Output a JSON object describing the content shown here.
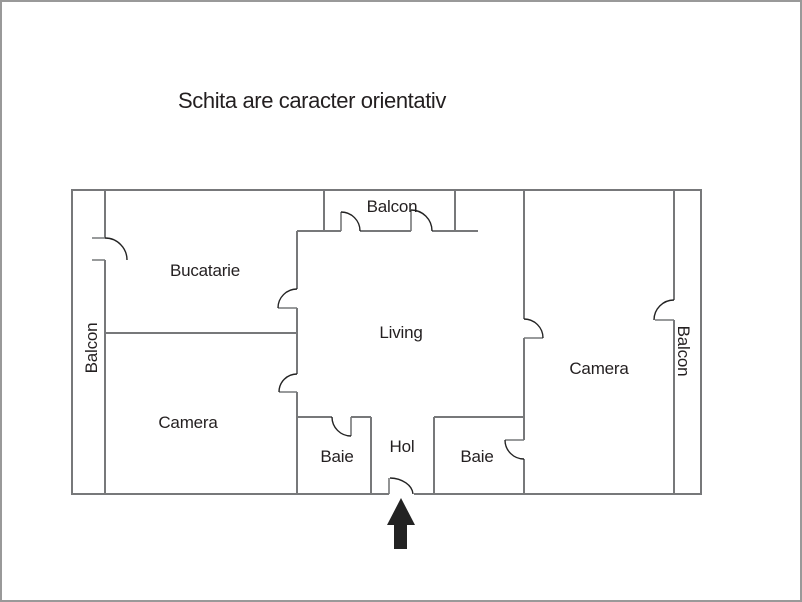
{
  "title": "Schita are caracter orientativ",
  "floor_plan": {
    "labels": {
      "balcony_top": "Balcon",
      "balcony_left": "Balcon",
      "balcony_right": "Balcon",
      "kitchen": "Bucatarie",
      "living": "Living",
      "bedroom_left": "Camera",
      "bedroom_right": "Camera",
      "bath_left": "Baie",
      "bath_right": "Baie",
      "hall": "Hol"
    },
    "colors": {
      "wall": "#77787a",
      "door_arc": "#232323",
      "text": "#231f20",
      "entrance_arrow": "#232323",
      "frame_border": "#999999"
    },
    "entrance_arrow_icon": "up-arrow"
  }
}
